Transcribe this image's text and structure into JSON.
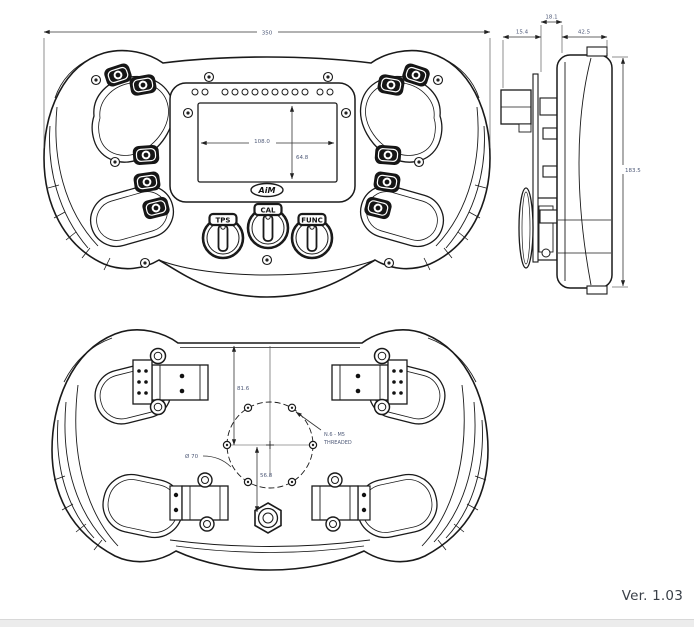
{
  "document": {
    "version_label": "Ver. 1.03"
  },
  "colors": {
    "line_ink": "#1a1a1a",
    "dimension_text": "#4f5a78",
    "footer_text": "#3a4048",
    "bottom_bar": "#ececec"
  },
  "front_view": {
    "dims": {
      "overall_width": "350",
      "display_width": "108.0",
      "display_height": "64.8"
    },
    "rotaries": [
      {
        "label": "TPS"
      },
      {
        "label": "CAL"
      },
      {
        "label": "FUNC"
      }
    ],
    "logo": "AiM"
  },
  "side_view": {
    "dims": {
      "plate_offset": "18.1",
      "connector_depth": "15.4",
      "body_depth": "42.5",
      "height": "183.5"
    }
  },
  "back_view": {
    "dims": {
      "top_to_center": "81.6",
      "center_to_bottom": "56.8",
      "bolt_circle": "Ø 70"
    },
    "thread_note": {
      "line1": "N.6 - M5",
      "line2": "THREADED"
    }
  }
}
